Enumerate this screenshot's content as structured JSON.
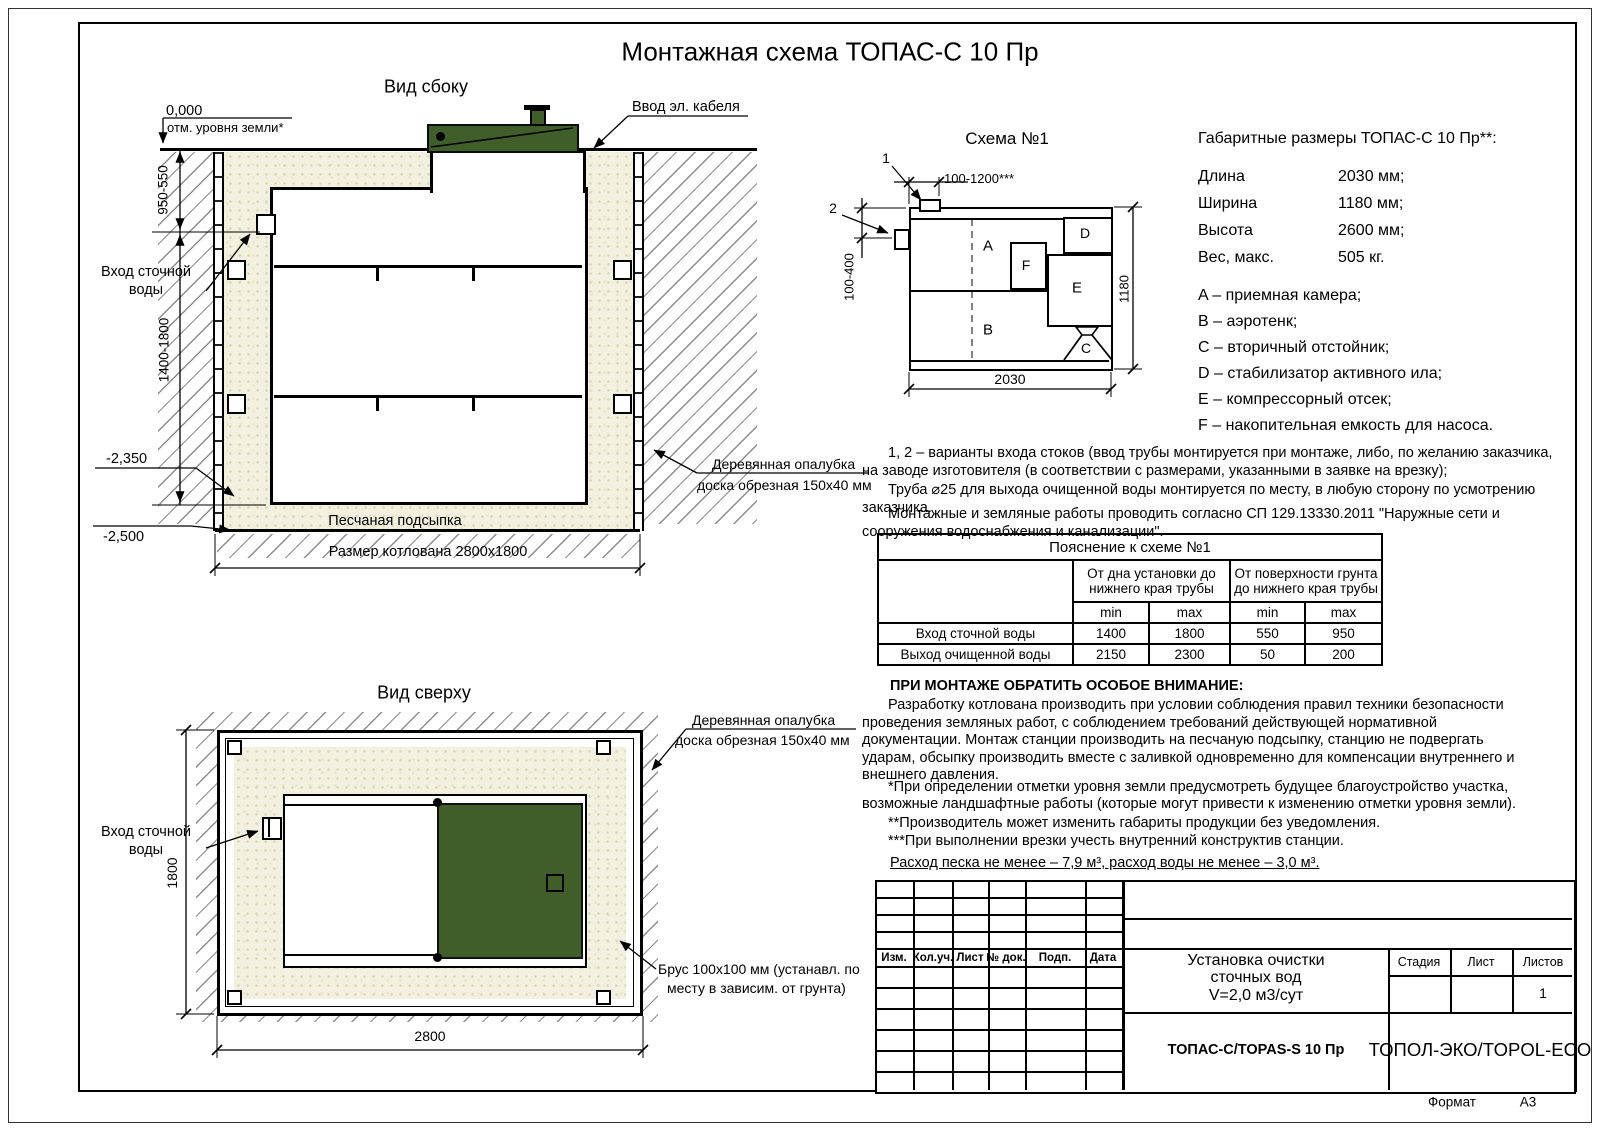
{
  "title": "Монтажная схема ТОПАС-С 10 Пр",
  "colors": {
    "lid_green": "#3f5e29",
    "sand": "#f2f0de"
  },
  "side_view": {
    "label": "Вид сбоку",
    "elev_zero": "0,000",
    "elev_zero_note": "отм. уровня земли*",
    "cable_label": "Ввод эл. кабеля",
    "inlet_line1": "Вход сточной",
    "inlet_line2": "воды",
    "dim_upper": "950-550",
    "dim_lower": "1400-1800",
    "elev_tank_bottom": "-2,350",
    "elev_pit_bottom": "-2,500",
    "sand_label": "Песчаная подсыпка",
    "pit_dim": "Размер котлована 2800x1800",
    "formwork_line1": "Деревянная опалубка",
    "formwork_line2": "доска обрезная 150x40 мм"
  },
  "top_view": {
    "label": "Вид сверху",
    "inlet_line1": "Вход сточной",
    "inlet_line2": "воды",
    "dim_height": "1800",
    "dim_width": "2800",
    "formwork_line1": "Деревянная опалубка",
    "formwork_line2": "доска обрезная 150x40 мм",
    "beam_line1": "Брус 100x100 мм (устанавл. по",
    "beam_line2": "месту в зависим. от грунта)"
  },
  "schema": {
    "title": "Схема №1",
    "inlet_variant_1": "1",
    "inlet_variant_2": "2",
    "dim_top": "100-1200***",
    "dim_left": "100-400",
    "dim_width": "2030",
    "dim_height": "1180",
    "compartments": {
      "a": "A",
      "b": "B",
      "c": "C",
      "d": "D",
      "e": "E",
      "f": "F"
    }
  },
  "specs": {
    "heading": "Габаритные размеры ТОПАС-С 10 Пр**:",
    "rows": [
      {
        "label": "Длина",
        "value": "2030 мм;"
      },
      {
        "label": "Ширина",
        "value": "1180 мм;"
      },
      {
        "label": "Высота",
        "value": "2600 мм;"
      },
      {
        "label": "Вес, макс.",
        "value": "505 кг."
      }
    ],
    "legend": [
      "A – приемная камера;",
      "B – аэротенк;",
      "C – вторичный отстойник;",
      "D – стабилизатор активного ила;",
      "E – компрессорный отсек;",
      "F – накопительная емкость для насоса."
    ]
  },
  "notes": {
    "p1": "1, 2 – варианты входа  стоков (ввод трубы монтируется при монтаже, либо, по желанию заказчика, на заводе изготовителя (в соответствии с размерами, указанными в заявке на врезку);",
    "p2": "Труба ⌀25 для выхода очищенной воды монтируется по месту, в любую сторону по усмотрению заказчика.",
    "p3": "Монтажные и земляные работы проводить согласно СП 129.13330.2011 \"Наружные сети и сооружения водоснабжения и канализации\"."
  },
  "table": {
    "title": "Пояснение к схеме №1",
    "group1_line1": "От дна установки до",
    "group1_line2": "нижнего края трубы",
    "group2_line1": "От поверхности грунта",
    "group2_line2": "до нижнего края трубы",
    "min": "min",
    "max": "max",
    "rows": [
      {
        "name": "Вход сточной воды",
        "values": [
          "1400",
          "1800",
          "550",
          "950"
        ]
      },
      {
        "name": "Выход очищенной воды",
        "values": [
          "2150",
          "2300",
          "50",
          "200"
        ]
      }
    ]
  },
  "attention": {
    "heading": "ПРИ МОНТАЖЕ ОБРАТИТЬ ОСОБОЕ ВНИМАНИЕ:",
    "p1": "Разработку котлована производить при условии соблюдения правил техники безопасности проведения земляных работ, с соблюдением требований действующей нормативной документации. Монтаж станции производить на песчаную подсыпку, станцию не подвергать ударам, обсыпку производить вместе с заливкой одновременно для компенсации внутреннего и внешнего давления.",
    "note1": "*При определении отметки уровня земли предусмотреть будущее благоустройство участка, возможные ландшафтные работы (которые могут привести к изменению отметки уровня земли).",
    "note2": "**Производитель может изменить габариты продукции без уведомления.",
    "note3": "***При выполнении врезки учесть внутренний конструктив станции.",
    "consumption": "Расход песка не менее – 7,9 м³, расход воды не менее – 3,0 м³."
  },
  "title_block": {
    "columns": [
      "Изм.",
      "Кол.уч.",
      "Лист",
      "№ док.",
      "Подп.",
      "Дата"
    ],
    "doc_line1": "Установка очистки",
    "doc_line2": "сточных вод",
    "doc_line3": "V=2,0 м3/сут",
    "stage_label": "Стадия",
    "sheet_label": "Лист",
    "sheets_label": "Листов",
    "sheets_value": "1",
    "model": "ТОПАС-С/TOPAS-S 10 Пр",
    "company": "ТОПОЛ-ЭКО/TOPOL-ECO",
    "format_label": "Формат",
    "format_value": "А3"
  }
}
